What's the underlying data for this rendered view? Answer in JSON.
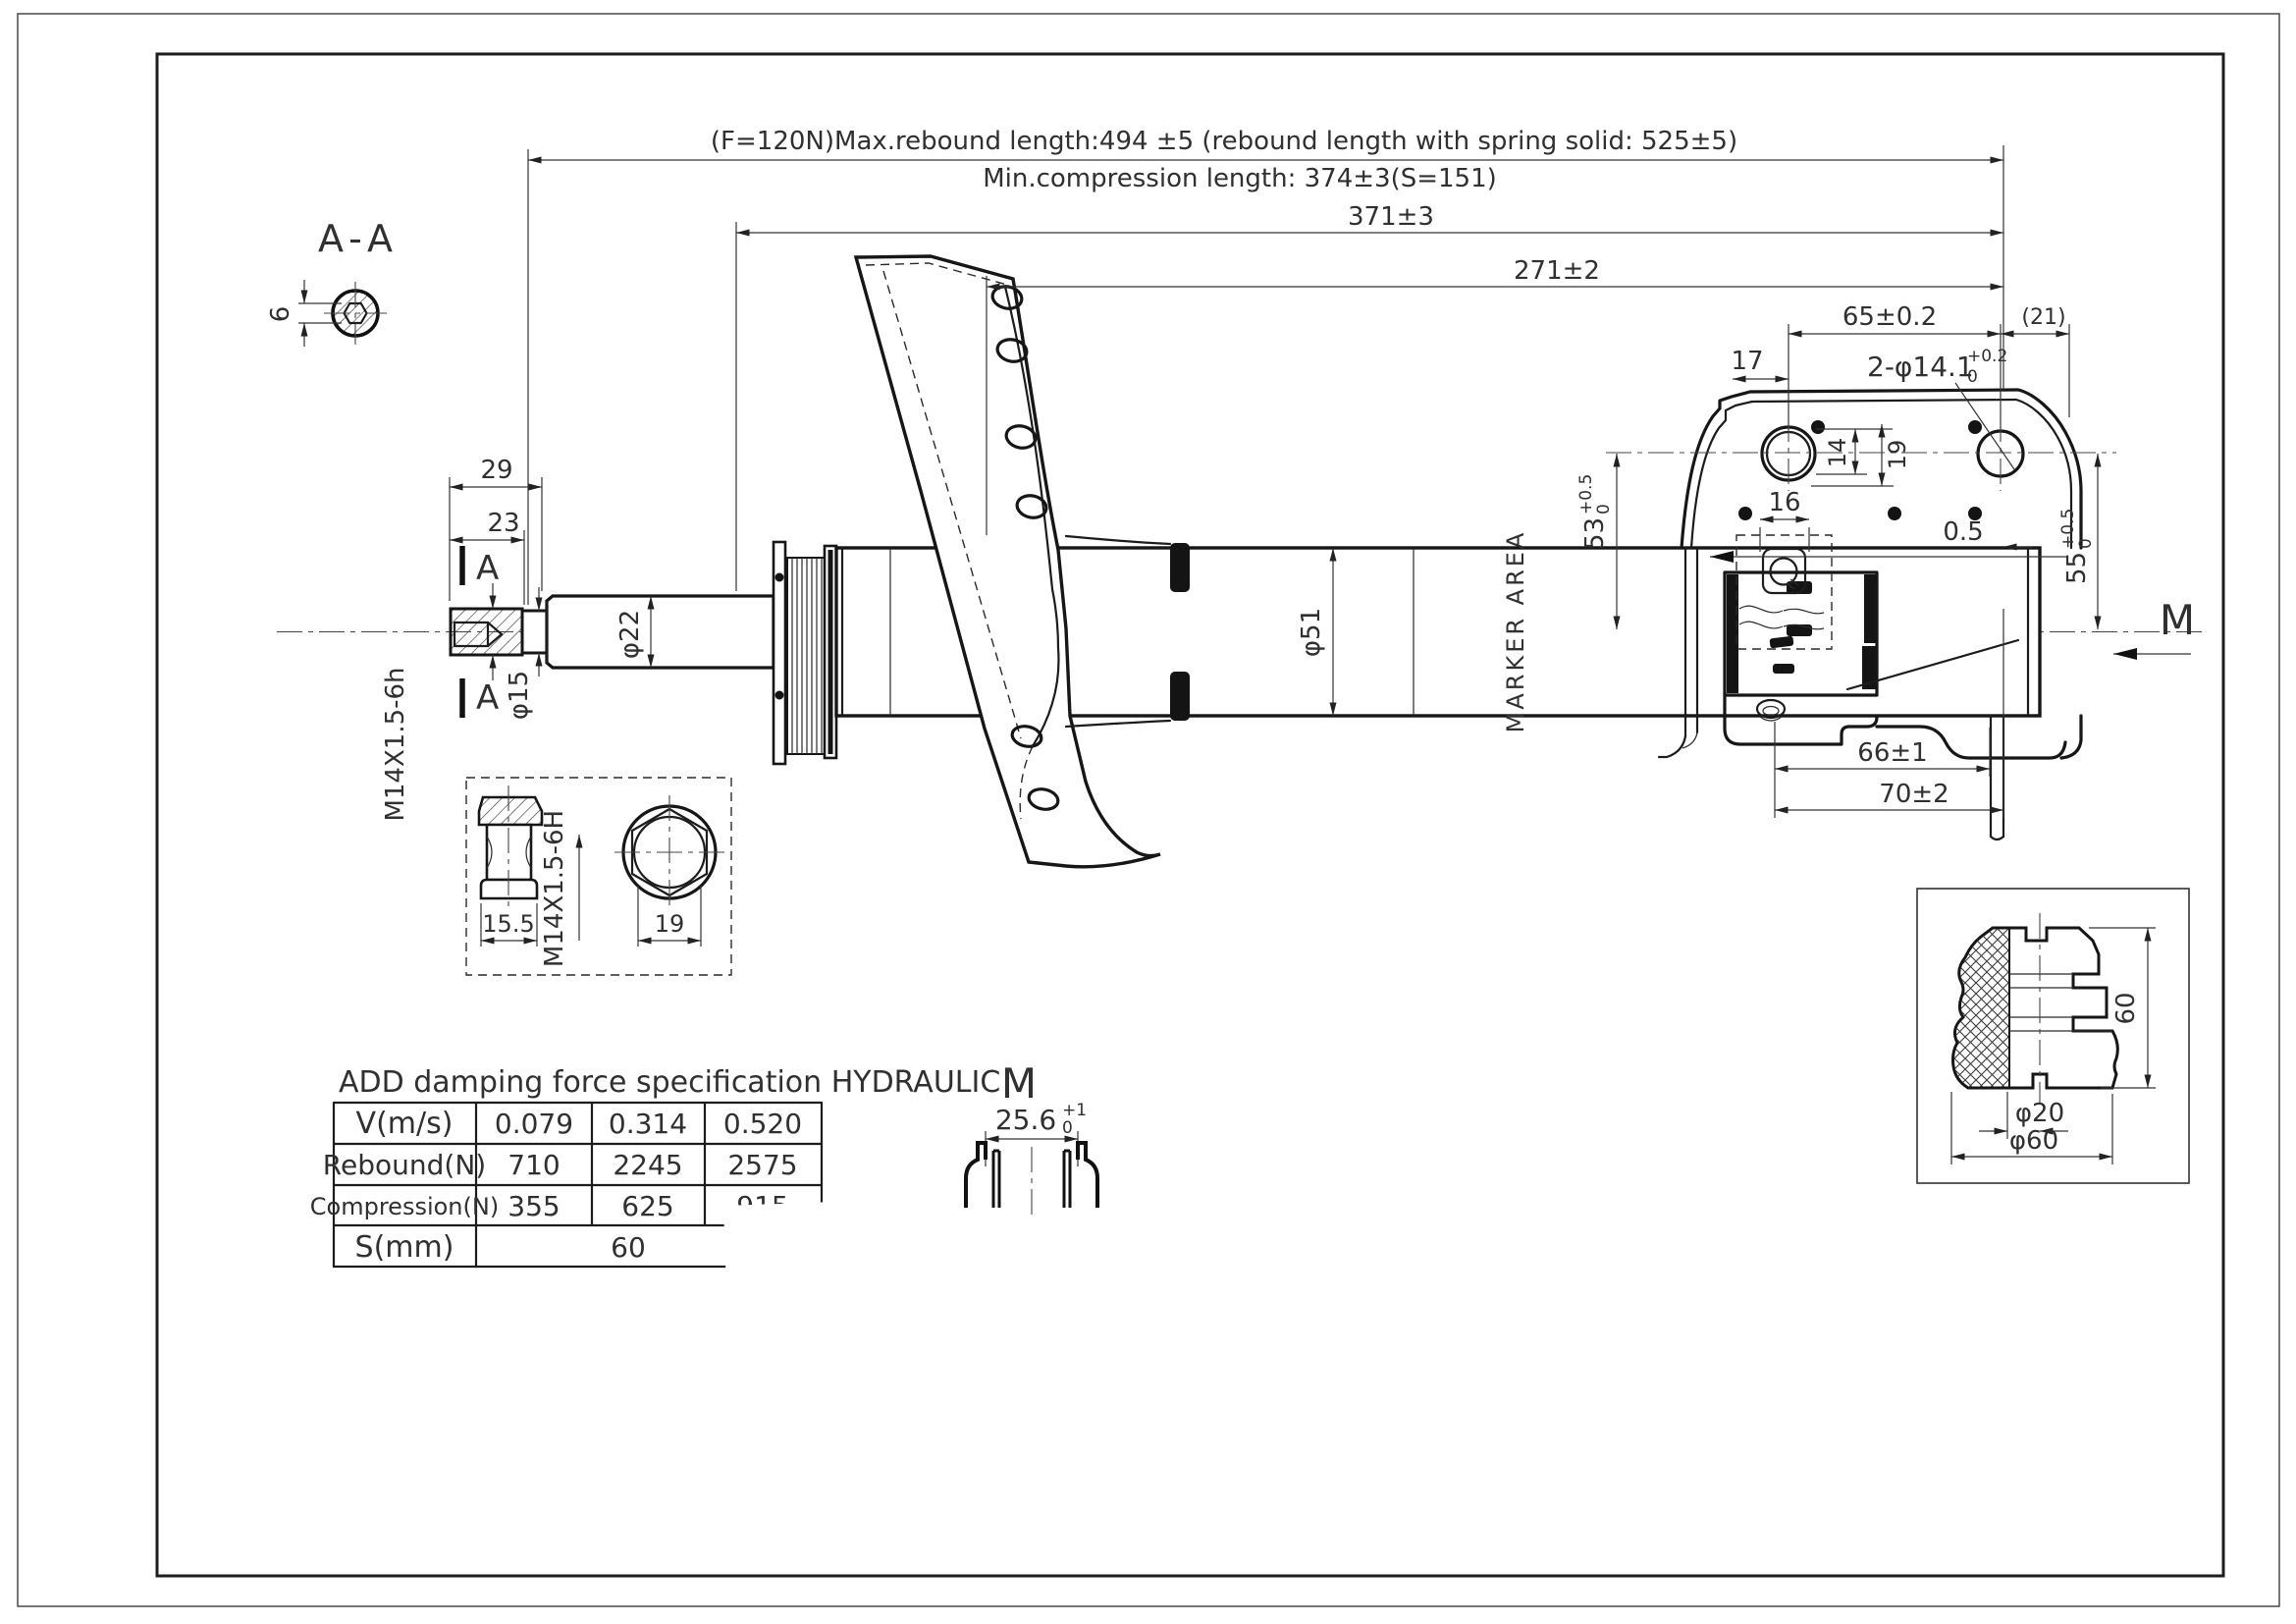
{
  "notes": {
    "line1": "(F=120N)Max.rebound length:494 ±5 (rebound length with spring solid: 525±5)",
    "line2": "Min.compression length: 374±3(S=151)"
  },
  "dimensions": {
    "overall_a": "371±3",
    "overall_b": "271±2",
    "bracket_span": "65±0.2",
    "bracket_ref": "(21)",
    "edge_offset": "17",
    "holes_label": "2-φ14.1",
    "holes_tol_up": "+0.2",
    "holes_tol_dn": "0",
    "hole_dim_a": "14",
    "hole_dim_b": "19",
    "nut_plate": "16",
    "center_a": "53",
    "center_a_tol_up": "+0.5",
    "center_a_tol_dn": "0",
    "center_b": "55",
    "center_b_tol_up": "+0.5",
    "center_b_tol_dn": "0",
    "gap": "0.5",
    "foot_a": "66±1",
    "foot_b": "70±2",
    "rod_len_a": "29",
    "rod_len_b": "23",
    "rod_thread": "M14X1.5-6h",
    "rod_neck": "φ15",
    "rod_dia": "φ22",
    "tube_dia": "φ51",
    "marker_area": "MARKER AREA",
    "section_mark": "A",
    "view_label": "M"
  },
  "section_aa": {
    "title": "A-A",
    "hex_af": "6"
  },
  "nut_detail": {
    "flange_w": "15.5",
    "thread": "M14X1.5-6H",
    "hex_af": "19"
  },
  "view_m": {
    "title": "M",
    "dim": "25.6",
    "tol_up": "+1",
    "tol_dn": "0"
  },
  "bumper": {
    "height": "60",
    "bore": "φ20",
    "od": "φ60"
  },
  "table": {
    "title": "ADD damping force specification HYDRAULIC",
    "rows": [
      [
        "V(m/s)",
        "0.079",
        "0.314",
        "0.520"
      ],
      [
        "Rebound(N)",
        "710",
        "2245",
        "2575"
      ],
      [
        "Compression(N)",
        "355",
        "625",
        "915"
      ],
      [
        "S(mm)",
        "60"
      ]
    ]
  }
}
